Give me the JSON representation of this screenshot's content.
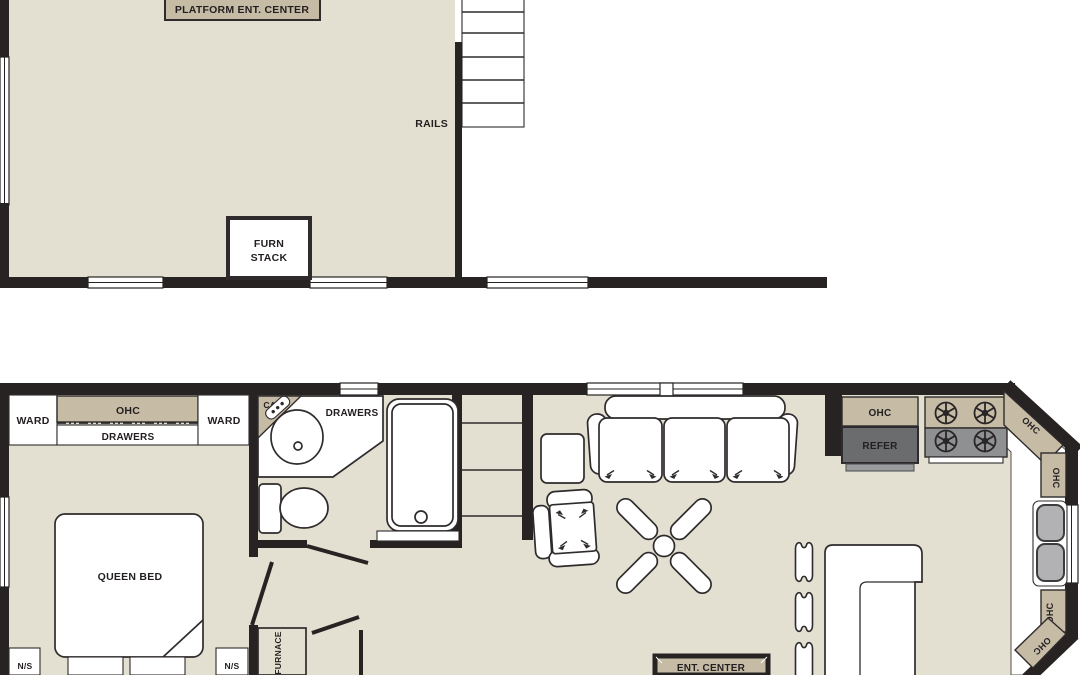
{
  "colors": {
    "floor": "#E3DFD1",
    "cabinet_tan": "#C6BCA6",
    "wall_black": "#272322",
    "refer_gray": "#6B6C6E",
    "refer_base_gray": "#9B9C9E",
    "stove_gray": "#8F9092",
    "sink_gray": "#B2B2B4",
    "line": "#2F2B2C",
    "text": "#231F20"
  },
  "loft": {
    "platform_label": "PLATFORM ENT. CENTER",
    "rails_label": "RAILS",
    "furn_stack_line1": "FURN",
    "furn_stack_line2": "STACK"
  },
  "bedroom": {
    "ward_left": "WARD",
    "ohc": "OHC",
    "drawers": "DRAWERS",
    "ward_right": "WARD",
    "queen_bed": "QUEEN BED",
    "ns_left": "N/S",
    "ns_right": "N/S"
  },
  "bathroom": {
    "cab": "CAB",
    "drawers": "DRAWERS"
  },
  "hall": {
    "furnace": "FURNACE"
  },
  "living": {
    "ent_center": "ENT. CENTER"
  },
  "kitchen": {
    "ohc_fridge": "OHC",
    "refer": "REFER",
    "ohc_corner_top": "OHC",
    "ohc_right_upper": "OHC",
    "ohc_right_lower": "OHC",
    "ohc_corner_bottom": "OHC"
  }
}
